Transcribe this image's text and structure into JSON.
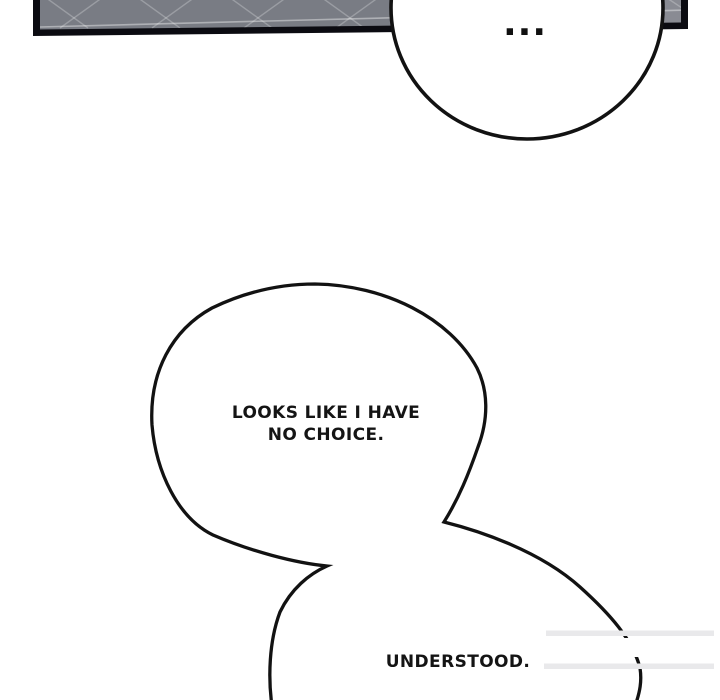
{
  "comic": {
    "bubbles": {
      "ellipsis": {
        "text": "..."
      },
      "main": {
        "line1": "LOOKS LIKE I HAVE",
        "line2": "NO CHOICE."
      },
      "reply": {
        "text": "UNDERSTOOD."
      }
    },
    "colors": {
      "background": "#ffffff",
      "bubble_fill": "#ffffff",
      "bubble_stroke": "#121212",
      "text": "#141414",
      "panel_fill": "#797c84",
      "panel_border": "#0b0b11",
      "panel_grid_line": "#ffffff",
      "erase_streak": "#e9e9eb"
    }
  }
}
